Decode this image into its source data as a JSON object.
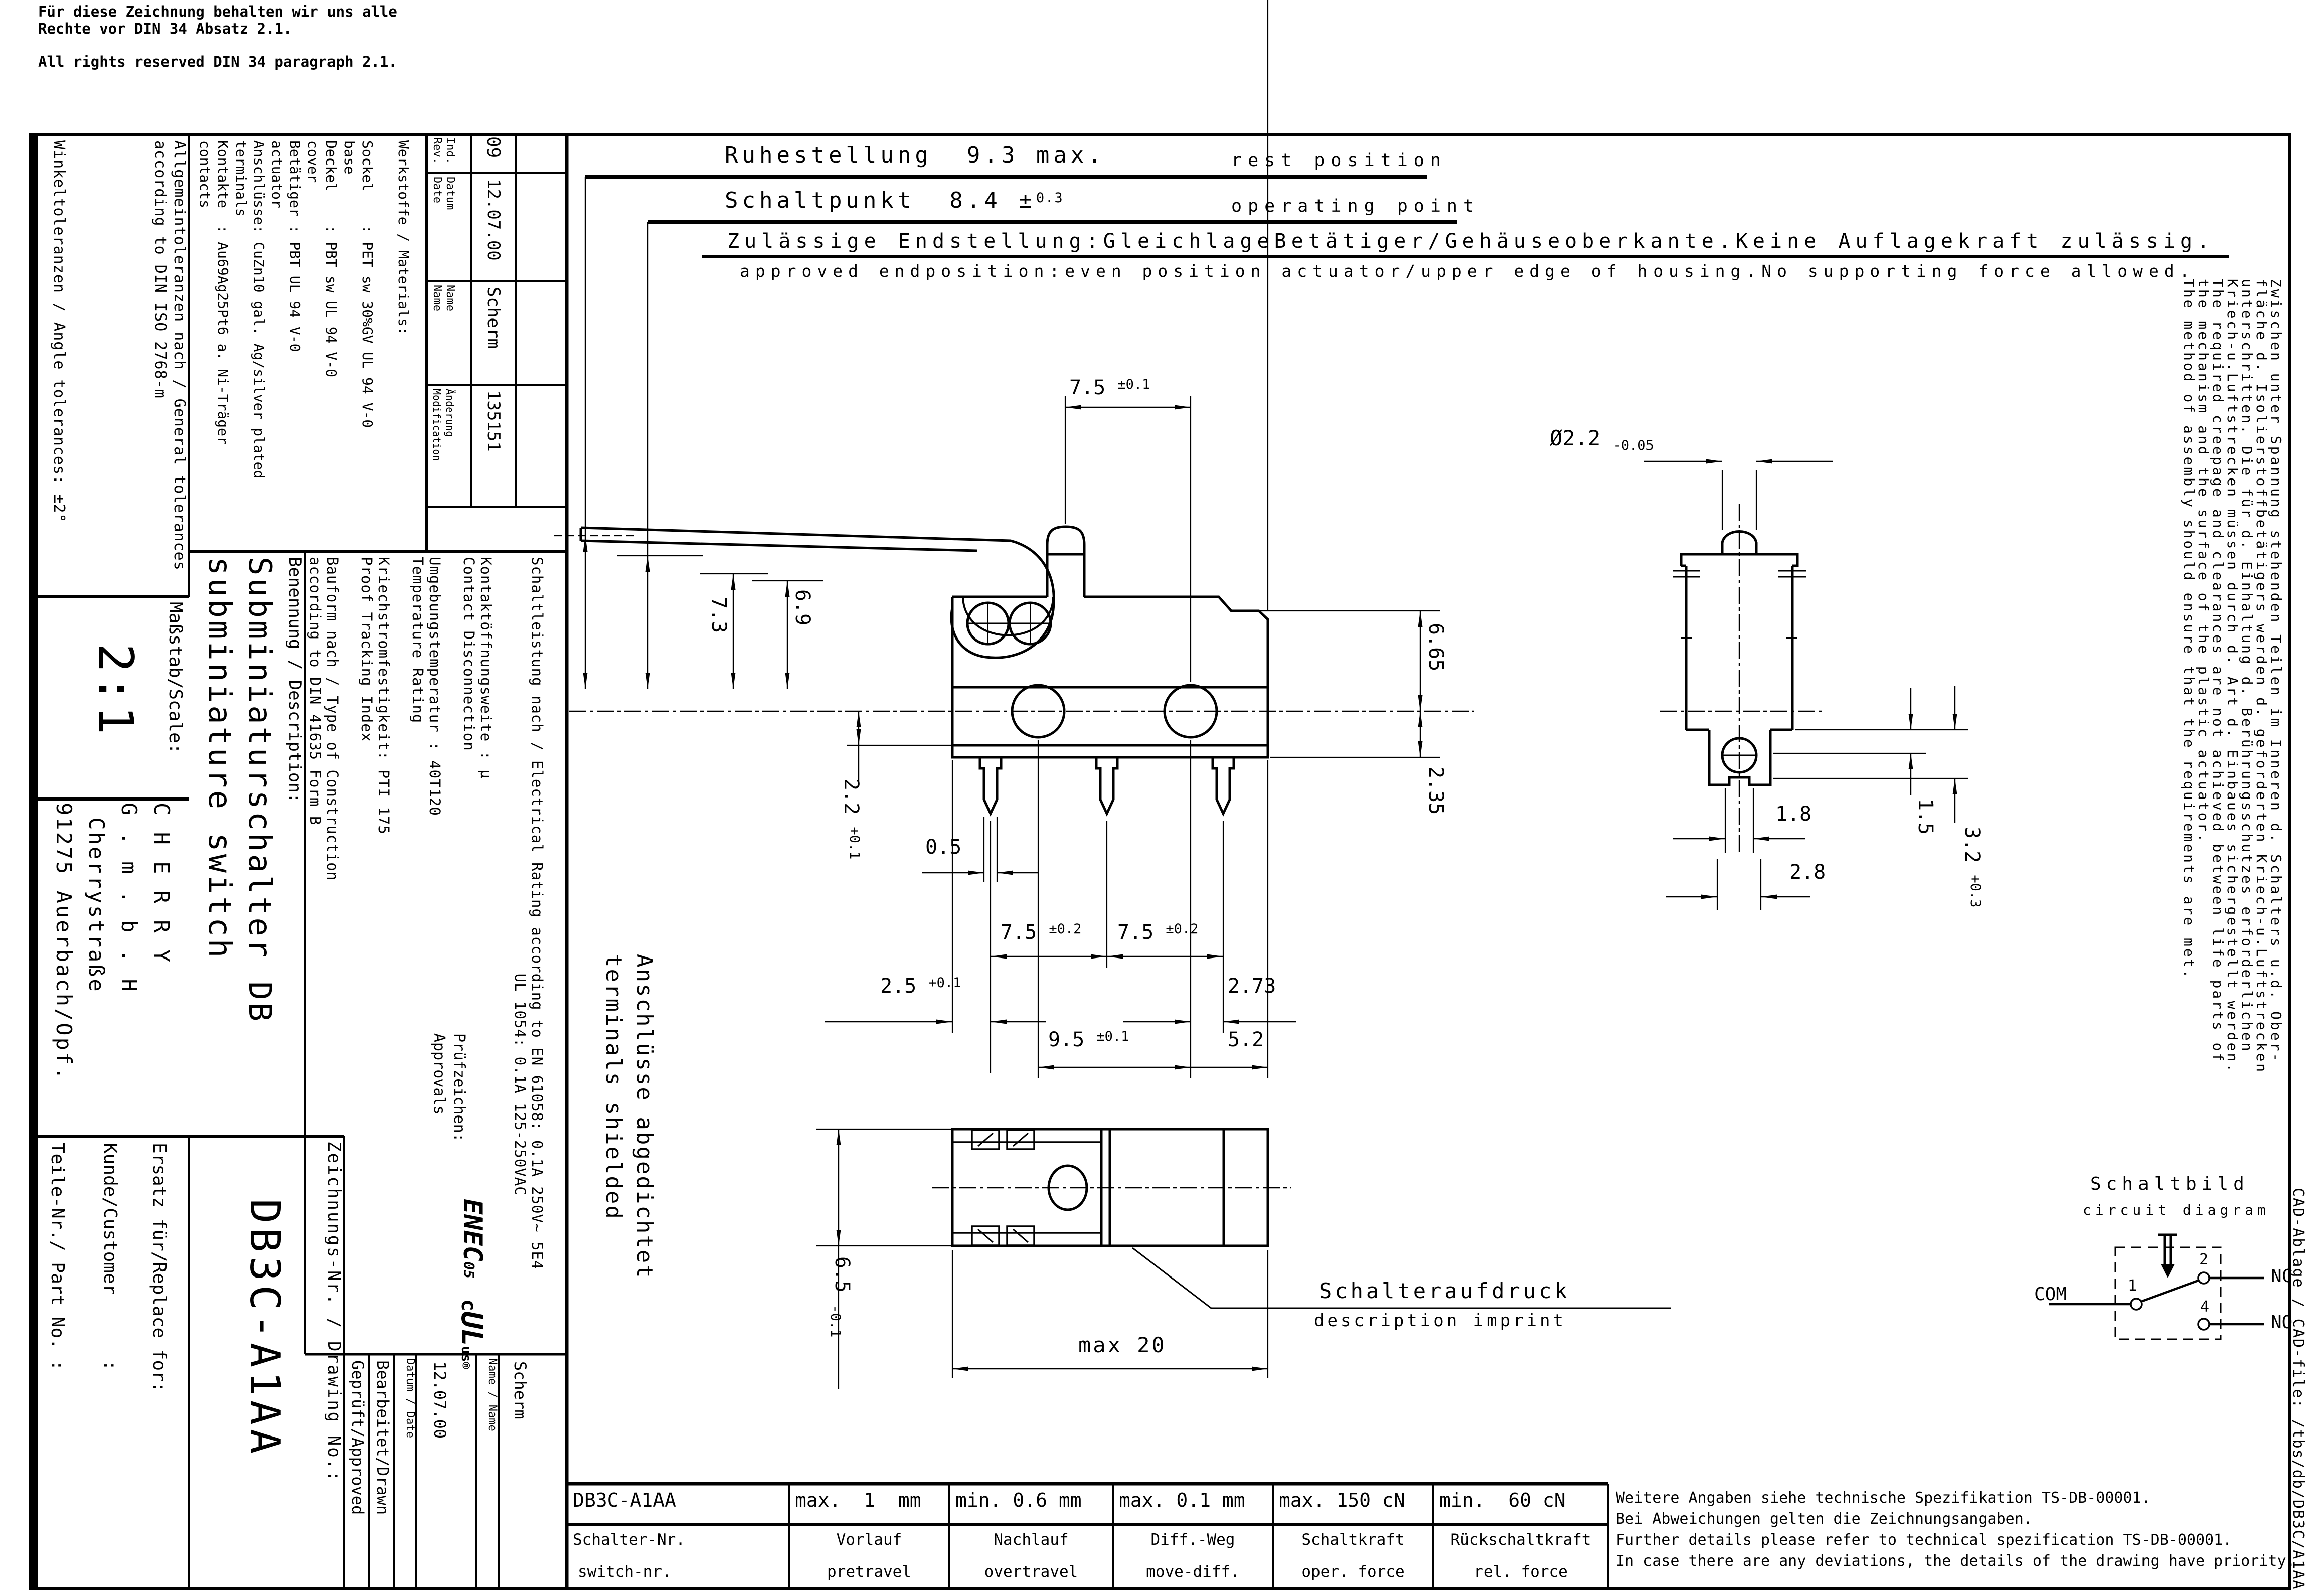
{
  "copyright": {
    "de1": "Für diese Zeichnung behalten wir uns alle",
    "de2": "Rechte vor DIN 34 Absatz 2.1.",
    "en": "All rights reserved DIN 34 paragraph 2.1."
  },
  "ann": {
    "ruhestellung": "Ruhestellung  9.3 max.",
    "rest": "rest position",
    "schaltpunkt": "Schaltpunkt  8.4 ±",
    "schaltpunkt_tol": "0.3",
    "operating": "operating point",
    "zulaessig": "Zulässige Endstellung:GleichlageBetätiger/Gehäuseoberkante.Keine Auflagekraft zulässig.",
    "approved": "approved endposition:even position actuator/upper edge of housing.No supporting force allowed."
  },
  "tb": {
    "tol1": "Allgemeintoleranzen nach / General tolerances\naccording to DIN ISO 2768-m",
    "tol2": "Winkeltoleranzen / Angle tolerances: ±2°",
    "materials": "Werkstoffe / Materials:\n\nSockel    : PET sw 30%GV UL 94 V-0\nbase\nDeckel    : PBT sw UL 94 V-0\ncover\nBetätiger : PBT UL 94 V-0\nactuator\nAnschlüsse: CuZn10 gal. Ag/silver plated\nterminals\nKontakte  : Au69Ag25Pt6 a. Ni-Träger\ncontacts",
    "rev": {
      "ind_l": "Ind.\nRev.",
      "ind_v": "09",
      "datum_l": "Datum\nDate",
      "datum_v": "12.07.00",
      "name_l": "Name\nName",
      "name_v": "Scherm",
      "aend_l": "Änderung\nModification",
      "aend_v": "135151"
    },
    "scale_l": "Maßstab/Scale:",
    "scale_v": "2:1",
    "company": "C H E R R Y\nG . m . b . H\n Cherrystraße\n91275 Auerbach/Opf.",
    "benennung_l": "Benennung / Description:",
    "title": "Subminiaturschalter DB\nsubminiature switch",
    "tech": "Schaltleistung nach / Electrical Rating according to EN 61058: 0.1A 250V~ 5E4\n                                             UL 1054: 0.1A 125-250VAC\n\nKontaktöffnungsweite : µ\nContact Disconnection\n\nUmgebungstemperatur : 40T120\nTemperature Rating\n\nKriechstromfestigkeit: PTI 175\nProof Tracking Index\n\nBauform nach / Type of Construction\naccording to DIN 41635 Form B",
    "pruef": "Prüfzeichen:\nApprovals",
    "enec": "ENEC",
    "enec05": "05",
    "ul_c": "c",
    "ul": "UL",
    "ul_us": "us",
    "ul_r": "®",
    "zeichnung_l": "Zeichnungs-Nr. / Drawing No.:",
    "zeichnung_v": "DB3C-A1AA",
    "ersatz": "Ersatz für/Replace for:",
    "kunde": "Kunde/Customer      :",
    "teile": "Teile-Nr./ Part No. :",
    "bearb": "Bearbeitet/Drawn",
    "gepr": "Geprüft/Approved",
    "datum_date": "Datum / Date",
    "name_name": "Name / Name",
    "drawn_date": "12.07.00",
    "drawn_name": "Scherm"
  },
  "dims": {
    "d75_1": "7.5 ",
    "d75_1t": "±0.1",
    "d73": "7.3",
    "d69": "6.9",
    "d665": "6.65",
    "d235": "2.35",
    "d22": "2.2 ",
    "d22t": "+0.1",
    "d05": "0.5",
    "d75a": "7.5 ",
    "d75at": "±0.2",
    "d75b": "7.5 ",
    "d75bt": "±0.2",
    "d25": "2.5 ",
    "d25t": "+0.1",
    "d273": "2.73",
    "d95": "9.5 ",
    "d95t": "±0.1",
    "d52": "5.2",
    "dphi": "Ø2.2 ",
    "dphit": "-0.05",
    "d18": "1.8",
    "d28": "2.8",
    "d15": "1.5",
    "d32": "3.2 ",
    "d32t": "+0.3",
    "d65": "6.5 ",
    "d65t": "-0.1",
    "dmax20": "max 20"
  },
  "labels": {
    "abgedichtet": "Anschlüsse abgedichtet\nterminals shielded",
    "aufdruck": "Schalteraufdruck",
    "imprint": "description imprint"
  },
  "circuit": {
    "title": "Schaltbild",
    "sub": "circuit diagram",
    "com": "COM",
    "nc": "NC",
    "no": "NO",
    "t1": "1",
    "t2": "2",
    "t4": "4"
  },
  "note_right": "Zwischen unter Spannung stehenden Teilen im Inneren d. Schalters u.d. Ober-\nfläche d. Isolierstoffbetätigers werden d. geforderten Kriech-u.Luftstrecken\nunterschritten. Die für d. Einhaltung d. Berührungsschutzes erforderlichen\nKriech-u.Luftstrecken müssen durch d. Art d. Einbaues sichergestellt werden.\nThe required creepage and clearances are not achieved between life parts of\nthe mechanism and the surface of the plastic actuator.\nThe method of assembly should ensure that the requirements are met.",
  "spec": {
    "r1": [
      "DB3C-A1AA",
      "max.  1  mm",
      "min. 0.6 mm",
      "max. 0.1 mm",
      "max. 150 cN",
      "min.  60 cN"
    ],
    "r2de": [
      "Schalter-Nr.",
      "Vorlauf",
      "Nachlauf",
      "Diff.-Weg",
      "Schaltkraft",
      "Rückschaltkraft"
    ],
    "r2en": [
      "switch-nr.",
      "pretravel",
      "overtravel",
      "move-diff.",
      "oper. force",
      "rel. force"
    ]
  },
  "note_bottom": "Weitere Angaben siehe technische Spezifikation TS-DB-00001.\nBei Abweichungen gelten die Zeichnungsangaben.\nFurther details please refer to technical spezification TS-DB-00001.\nIn case there are any deviations, the details of the drawing have priority.",
  "cad": "CAD-Ablage / CAD-file: /tbs/db/DB3C/A1AA"
}
